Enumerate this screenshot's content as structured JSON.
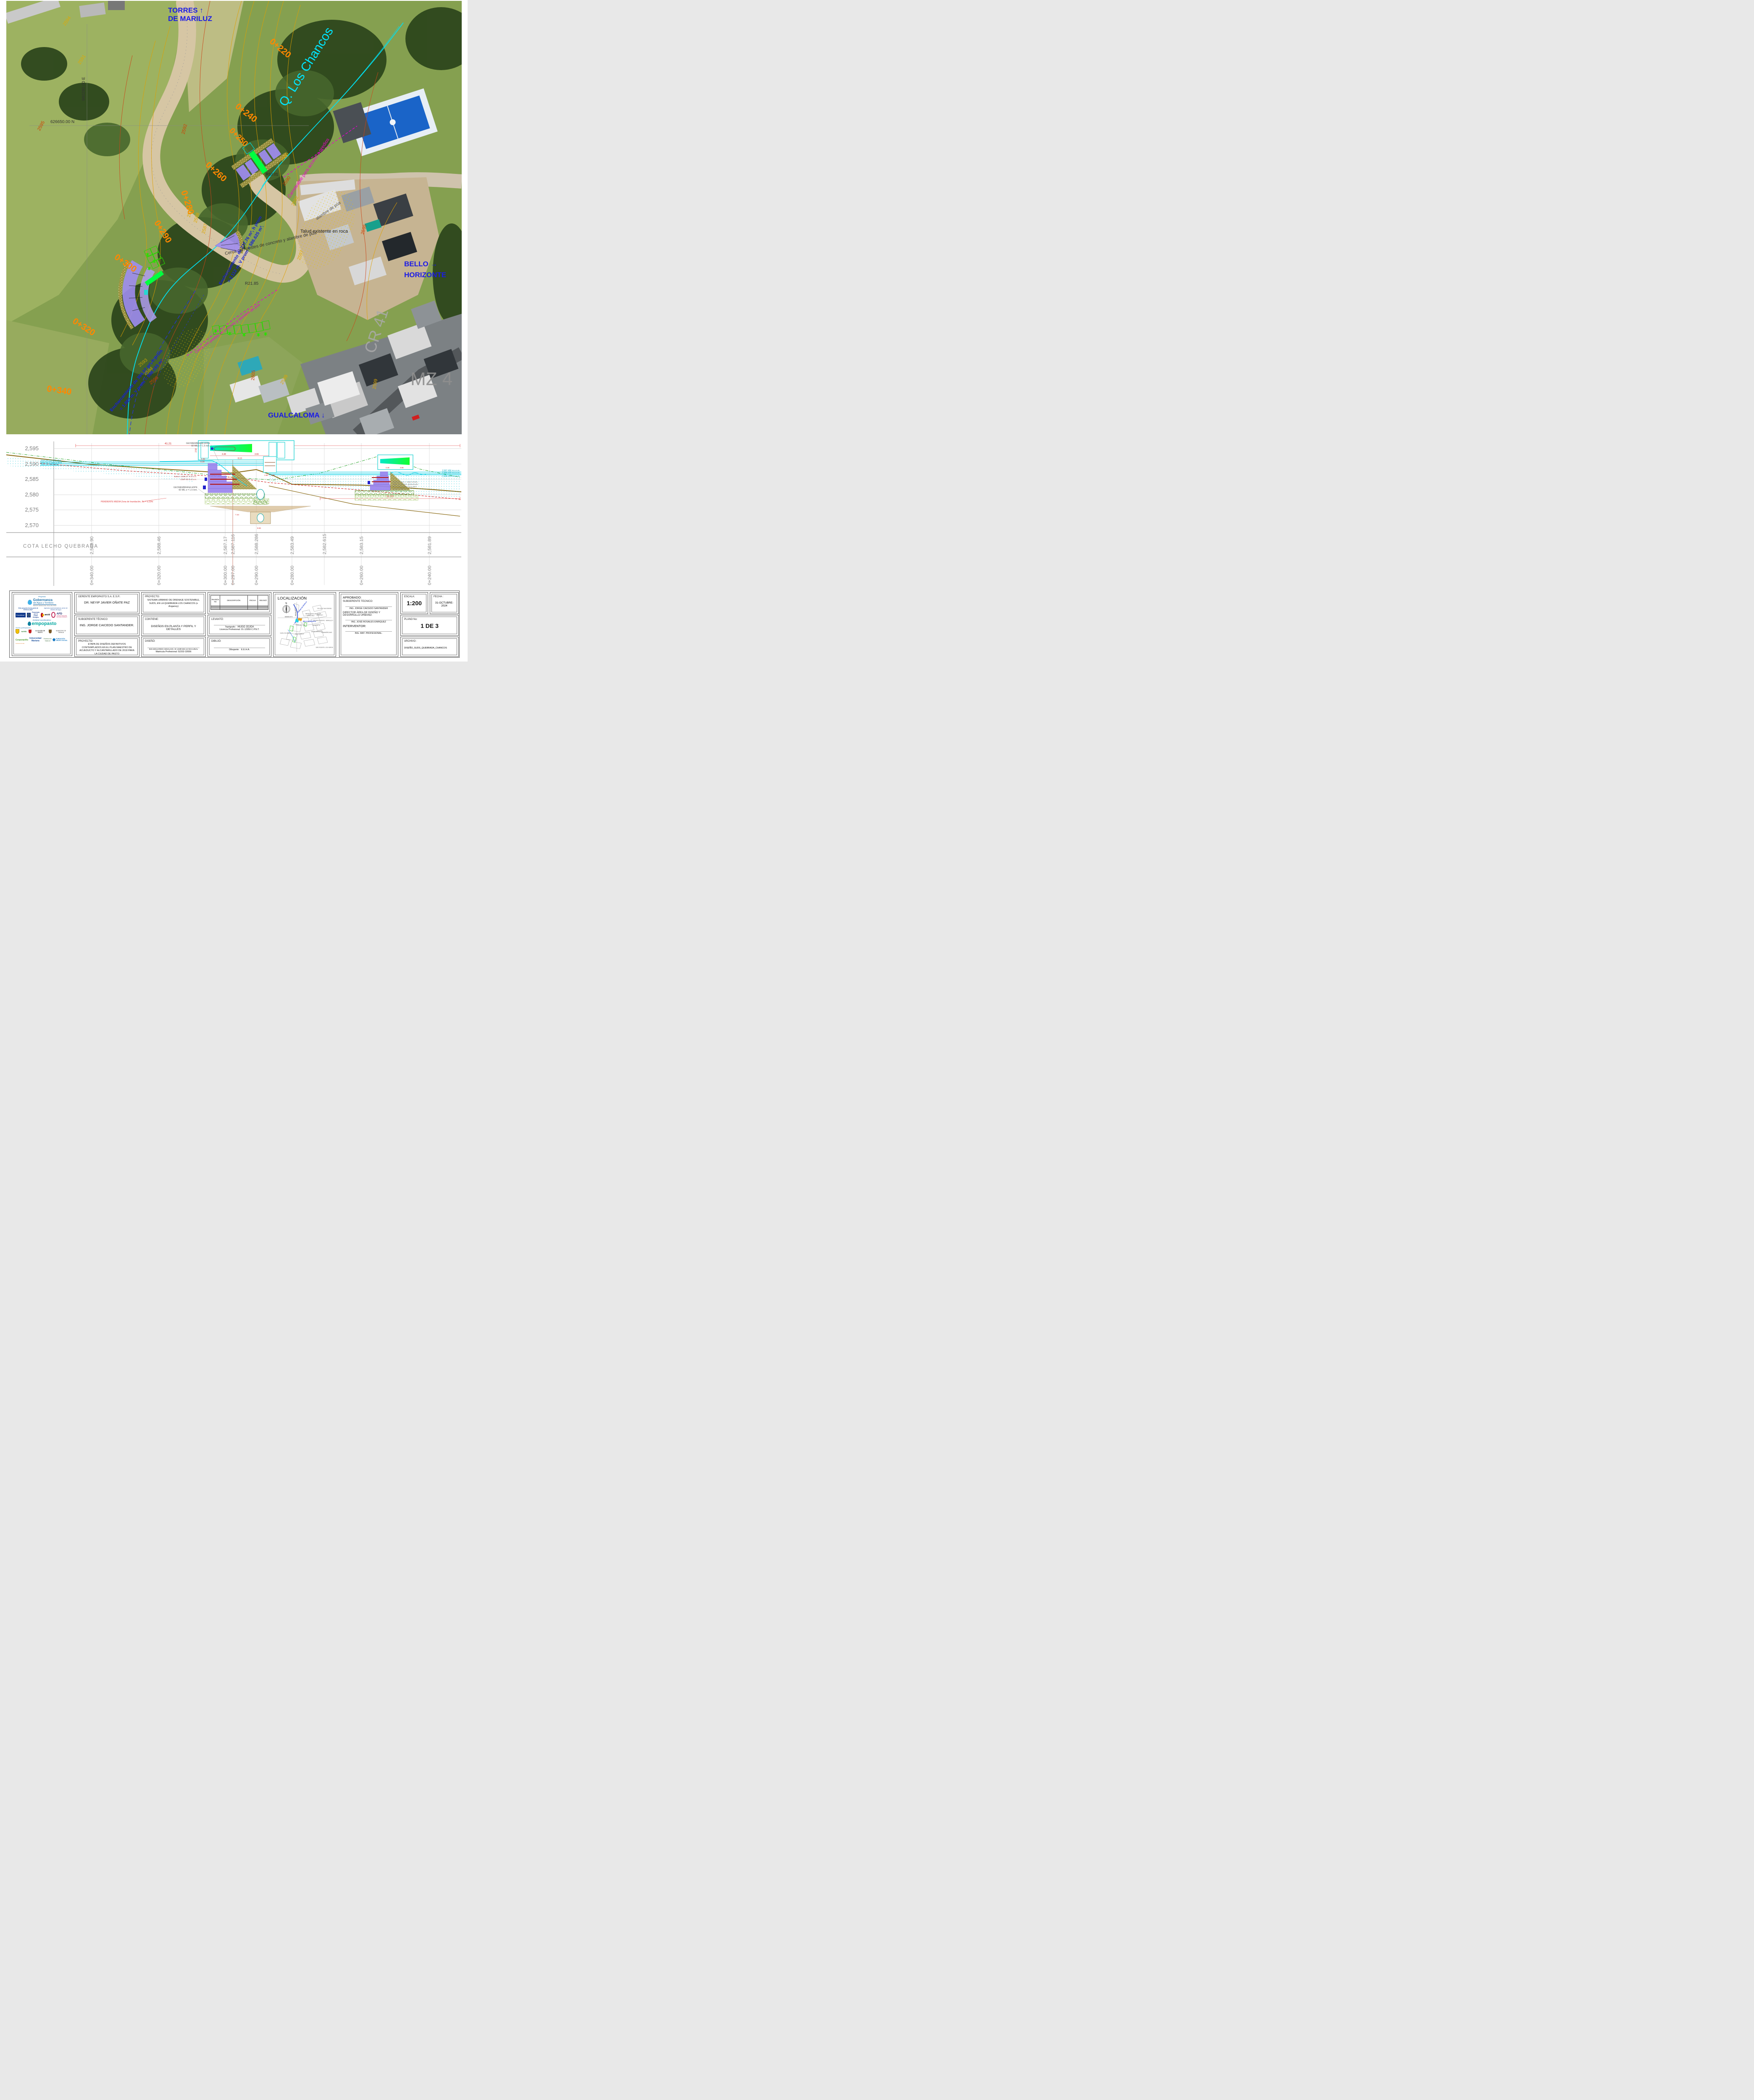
{
  "plan": {
    "area_labels": {
      "torres_l1": "TORRES  ↑",
      "torres_l2": "DE MARILUZ",
      "creek": "Q. Los Chancos",
      "bello_l1": "BELLO  →",
      "bello_l2": "HORIZONTE",
      "gualcaloma": "GUALCALOMA ↓",
      "cr41": "CR 41",
      "mz4": "MZ 4",
      "grid_n": "626650.00 N",
      "grid_e": "980280.00 E"
    },
    "stations": [
      "0+220",
      "0+240",
      "0+250",
      "0+260",
      "0+280",
      "0+290",
      "0+300",
      "0+320",
      "0+340"
    ],
    "contours": [
      "2594",
      "2591",
      "2595",
      "2592",
      "2588",
      "2590",
      "2589",
      "2588",
      "2587",
      "2592",
      "2597",
      "2595",
      "2593",
      "2594",
      "2595",
      "2605",
      "2599",
      "2599"
    ],
    "annotations": {
      "talud": "Talud existente en roca",
      "ench1_l1": "Encharcamiento de 277.76 m², h prom",
      "ench1_l2": "= 2.112 m. V prom = 586.625 m³.",
      "ench2_l1": "Encharcamiento de 394.07 m², h prom",
      "ench2_l2": "= 1.883 m. V prom = 598.193 m³.",
      "carreteable": "Carreteable para acceso a predios",
      "alambre": "alambre de púa",
      "cerca": "Cerca con postes de concreto y alambre de púa",
      "r1": "R21.85",
      "r2": "R10.01"
    }
  },
  "profile": {
    "elevations": [
      "2,595",
      "2,590",
      "2,585",
      "2,580",
      "2,575",
      "2,570"
    ],
    "cota_label": "COTA  LECHO  QUEBRADA",
    "columns": [
      {
        "value": "2,589.90",
        "station": "0+340.00"
      },
      {
        "value": "2,588.46",
        "station": "0+320.00"
      },
      {
        "value": "2,587.17",
        "station": "0+300.00"
      },
      {
        "value": "2,587.116",
        "station": "0+297.00"
      },
      {
        "value": "2,588.286",
        "station": "0+290.00"
      },
      {
        "value": "2,583.49",
        "station": "0+280.00"
      },
      {
        "value": "2,582.615",
        "station": ""
      },
      {
        "value": "2,583.15",
        "station": "0+260.00"
      },
      {
        "value": "2,581.89",
        "station": "0+240.00"
      }
    ],
    "levels": [
      "Nivel de Q tr=20 años",
      "Nivel de Q banca llena",
      "Nivel de Retención"
    ],
    "msnm": [
      "2,587.456 m.s.n.m.",
      "2,586.926 m.s.n.m.",
      "2,586.614 m.s.n.m."
    ],
    "batea": "Batea: 2,588.27 m.s.n.m.",
    "batea2": "2,587.53 m.s.n.m.",
    "geomembrana_l1": "GEOMEMBRANA HDPE",
    "geomembrana_l2": "60 MIL e = 1.5 mm.",
    "pendiente": "PENDIENTE MEDIA Zona de Inundación,  So = 5.23%",
    "gaviones_l1": "Gaviones tipo A, triple torsión,",
    "gaviones_l2": "malla de alambre galvanizado",
    "gaviones_l3": "NTC 2403, calibre 12 y para",
    "gaviones_l4": "amarre calibre 12.",
    "dims": {
      "d4121": "41.21",
      "d3183": "31.83",
      "d448": "4.48",
      "d366": "3.66",
      "d813": "8.13",
      "d030": "0.30",
      "d120": "1.20",
      "d250": "2.50",
      "d180": "1.80",
      "d060": "0.60",
      "d993": "9.93",
      "d744": "7.44"
    }
  },
  "titleblock": {
    "logos": {
      "proyecto": "Proyecto",
      "gobernanza": "Gobernanza",
      "gobernanza_sub": "del Agua y Territorio",
      "gobernanza_region": "REGIÓN HÍDRICA DEL VALLE DE ATRIZ",
      "euroclima_note": "Este proyecto forma parte de EUROCLIMA+",
      "agencias_note": "Agencias implementadoras sector de Gestión del Agua",
      "euroclima": "Euroclima+",
      "eu_funding": "Financiado por la Unión Europea",
      "aecid": "aecid",
      "afd": "AFD",
      "afd_sub": "AGENCE FRANÇAISE DE DEVELOPPEMENT",
      "entidad": "Entidad coordinadora:",
      "empopasto": "empopasto",
      "socios": "Socios participantes:",
      "narino": "NARIÑO",
      "alcaldia": "ALCALDÍA DE PASTO",
      "tangua": "MUNICIPIO DE TANGUA",
      "corponarino": "Corponariño",
      "corponarino_sub": "Conserva la vida.",
      "umariana": "Universidad Mariana",
      "patrimonio": "Patrimonio Natural",
      "fundacion": "FUNDACIÓN GRUPO SOCIAL"
    },
    "gerente_label": "GERENTE EMPOPASTO S.A. E.S.P.:",
    "gerente": "DR. NEYIP JAVIER OÑATE PAZ",
    "subgerente_label": "SUBGERENTE TÉCNICO",
    "subgerente": "ING. JORGE CAICEDO SANTANDER.",
    "proyecto1_label": "PROYECTO:",
    "proyecto1": "ETAPA DE DISEÑOS DEFINITIVOS CONTEMPLADOS EN EL PLAN MAESTRO DE ACUEDUCTO Y ALCANTARILLADO DE 2018 PARA LA CIUDAD DE PASTO",
    "proyecto2_label": "PROYECTO:",
    "proyecto2": "SISTEMA URBANO DE DRENAJE SOSTENIBLE, SUDS, EN LA QUEBRADA LOS CHANCOS (o Anganoy)",
    "contiene_label": "CONTIENE:",
    "contiene": "DISEÑOS EN PLANTA Y PERFIL Y DETALLES",
    "diseno_label": "DISEÑÓ:",
    "diseno": "ING.EDUARDO.HIDALGO,-IC.UNR-EE.UV-EH.UNAL",
    "diseno_mat_label": "Matricula Profesional:",
    "diseno_mat": "52202-32656",
    "rev_headers": [
      "Revisión No",
      "DESCRIPCIÓN",
      "FECHA",
      "REVISÓ"
    ],
    "levanto_label": "LEVANTÓ:",
    "levanto_cargo": "Topógrafo:",
    "levanto": "HUGO JOJOA",
    "levanto_lic": "Licencia Profesional: 01-12959 C.P.N.T.",
    "dibujo_label": "DIBUJÓ:",
    "dibujo_cargo": "Dibujante:",
    "dibujo": "E.E.H.A.",
    "localizacion_label": "LOCALIZACIÓN",
    "loc_labels": [
      "TORRES DE MARILUZ",
      "MIRADOR DE SAN JUAN",
      "VERACRUZ",
      "VILLA DE SAN RAFAEL",
      "MARILUZ I",
      "BELLO HORIZONTE",
      "ED BARLOVENTO - MARILUZ II",
      "MARILUZ III",
      "GUALCALOMA",
      "GUALCALOMA IV",
      "SINDAMANOY",
      "JORGE GIRALDO",
      "PANAMERICANO",
      "SAN VICENTE",
      "LOS HEROES",
      "626650.00 N",
      "980280.00 E",
      "N"
    ],
    "aprobado_label": "APROBADO:",
    "aprobado_sub_label": "SUBGERENTE TECNICO:",
    "aprobado_sub": "ING. JORGE CAICEDO SANTANDER",
    "aprobado_dir_label": "DIRECTOR ÁREA DE DISEÑO Y DESARROLLO URBANO:",
    "aprobado_dir": "ING. JOSÉ ROSALES ENRIQUEZ",
    "interventor_label": "INTERVENTOR:",
    "interventor": "ING. MAT. PROFESIONAL.",
    "escala_label": "ESCALA:",
    "escala": "1:200",
    "fecha_label": "FECHA :",
    "fecha": "31-OCTUBRE-2024",
    "plano_label": "PLANO No:",
    "plano": "1 DE 3",
    "archivo_label": "ARCHIVO :",
    "archivo": "DISEÑO_SUDS_QUEBRADA_CHANCOS"
  }
}
